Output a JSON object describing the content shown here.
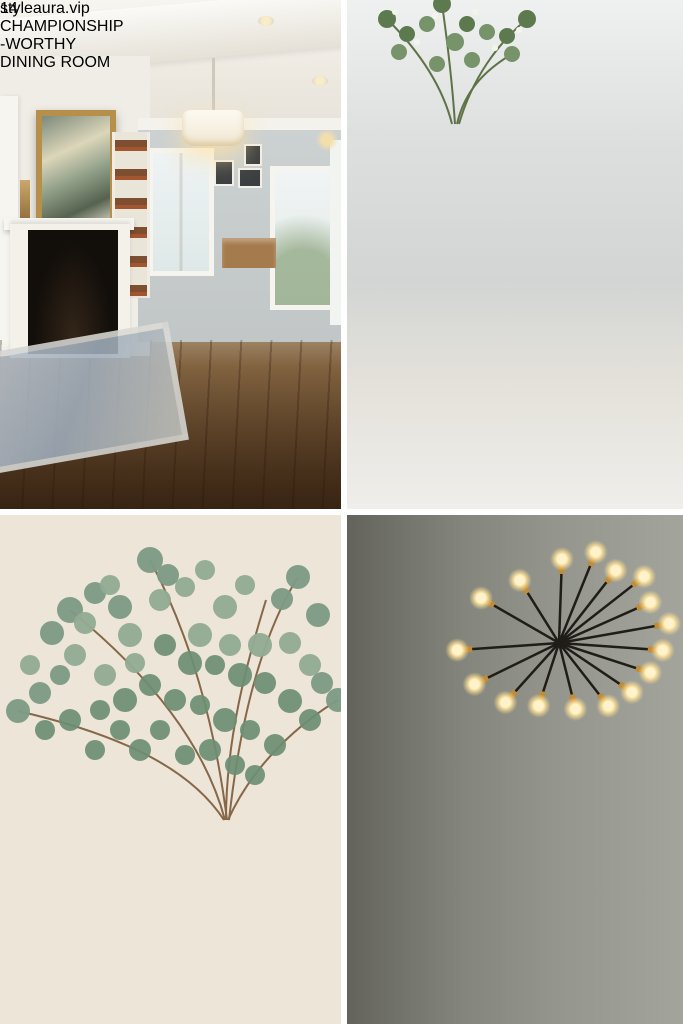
{
  "colors": {
    "badge_navy": "#263a62",
    "pill_navy": "#2b3e64",
    "title_text": "#0b0b0c",
    "title_outline": "#ffffff",
    "gutter": "#ffffff"
  },
  "title_badge": {
    "lines": [
      "14",
      "CHAMPIONSHIP",
      "-WORTHY",
      "DINING ROOM"
    ]
  },
  "footer_badge": {
    "url": "styleaura.vip"
  },
  "collage": {
    "photos": [
      {
        "id": "top-left",
        "label": "traditional dining room with fireplace and windsor chairs"
      },
      {
        "id": "top-right",
        "label": "gray linen tablescape with woven placemats on marble"
      },
      {
        "id": "bottom-left",
        "label": "eucalyptus in glass vase with ceramic bowls on wood table"
      },
      {
        "id": "bottom-right",
        "label": "modern dining room with sputnik chandelier and rustic table"
      }
    ]
  }
}
